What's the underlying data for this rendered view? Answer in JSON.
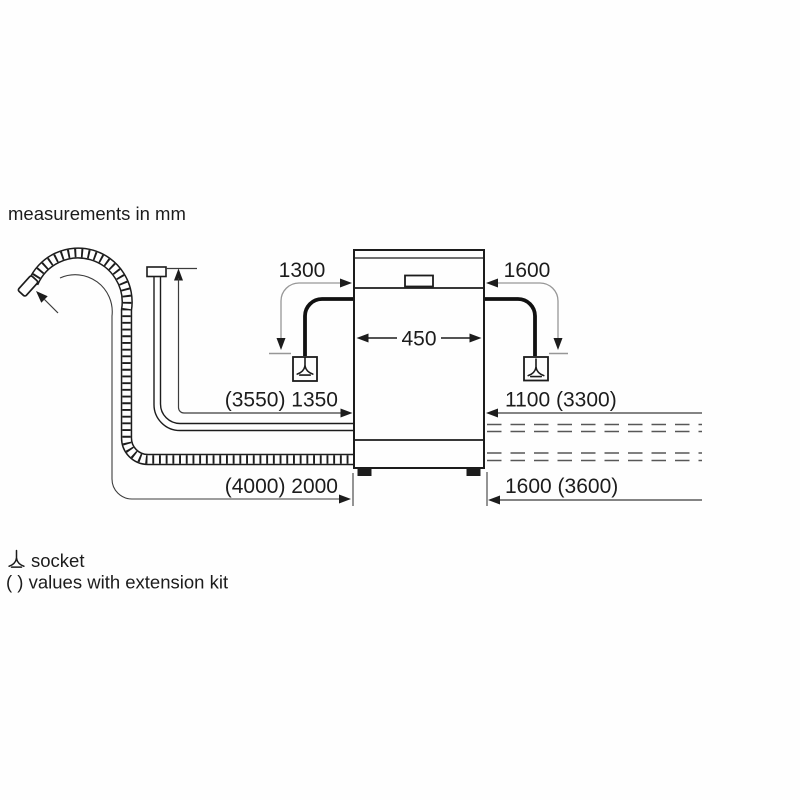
{
  "note": "measurements in mm",
  "dimensions": {
    "cable_left": "1300",
    "cable_right": "1600",
    "width": "450",
    "supply_hose": "(3550) 1350",
    "drain_hose": "(4000) 2000",
    "right_upper": "1100 (3300)",
    "right_lower": "1600 (3600)"
  },
  "legend": {
    "socket": "socket",
    "extension": "( ) values with extension kit"
  },
  "icons": {
    "socket": "earthed-socket-icon",
    "dimension_arrow": "arrowhead-icon"
  },
  "colors": {
    "line": "#1c1c1c",
    "dimension": "#3c3c3c",
    "leader": "#979797",
    "dashed": "#575757",
    "background": "#ffffff"
  }
}
